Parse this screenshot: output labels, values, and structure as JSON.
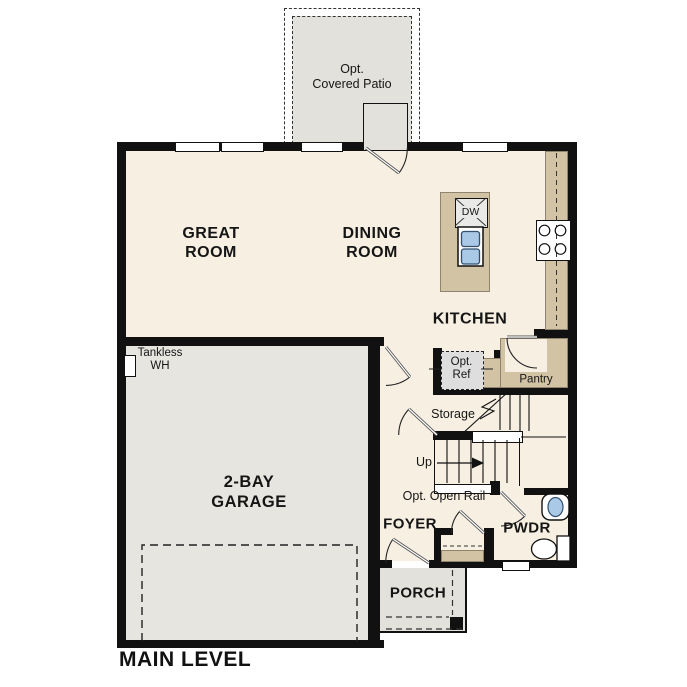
{
  "plan_title": "MAIN LEVEL",
  "labels": {
    "patio_l1": "Opt.",
    "patio_l2": "Covered Patio",
    "great_l1": "GREAT",
    "great_l2": "ROOM",
    "dining_l1": "DINING",
    "dining_l2": "ROOM",
    "kitchen": "KITCHEN",
    "dw": "DW",
    "pantry": "Pantry",
    "ref_l1": "Opt.",
    "ref_l2": "Ref",
    "tankless_l1": "Tankless",
    "tankless_l2": "WH",
    "storage": "Storage",
    "up": "Up",
    "open_rail": "Opt. Open Rail",
    "foyer": "FOYER",
    "pwdr": "PWDR",
    "porch": "PORCH",
    "garage_l1": "2-BAY",
    "garage_l2": "GARAGE",
    "main_level": "MAIN LEVEL"
  },
  "colors": {
    "floor_cream": "#f7efe2",
    "garage_gray": "#e7e5e0",
    "patio_gray": "#e3e1dc",
    "counter_tan": "#d2c3a4",
    "wall_black": "#111111",
    "sink_blue": "#a9c9e6"
  }
}
